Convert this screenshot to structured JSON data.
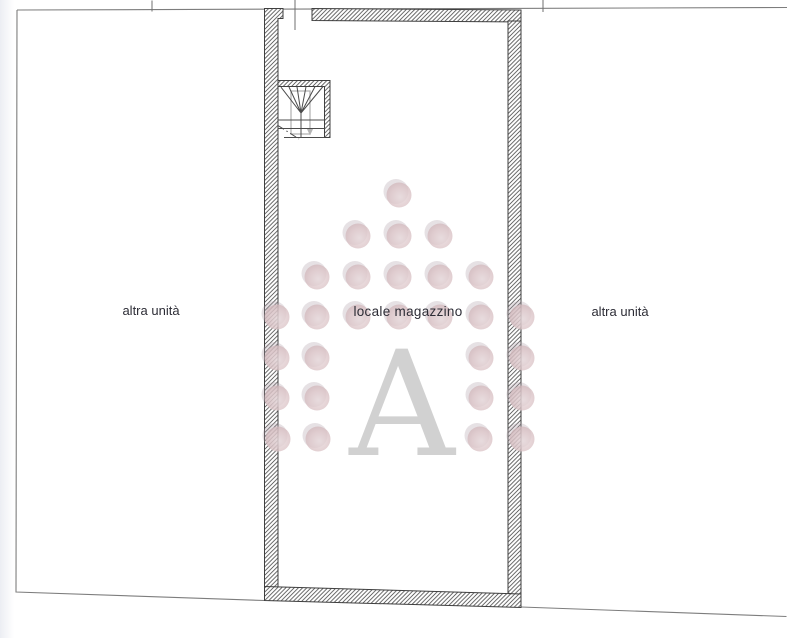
{
  "labels": {
    "left_unit": "altra unità",
    "storage_room": "locale magazzino",
    "right_unit": "altra unità"
  },
  "watermark": {
    "letter": "A",
    "letter_color": "#c8c8c8",
    "circle_color": "#ddc6c9",
    "circle_radius": 12.5,
    "rows": [
      {
        "y": 195,
        "xs": [
          399
        ]
      },
      {
        "y": 236,
        "xs": [
          358,
          399,
          440
        ]
      },
      {
        "y": 277,
        "xs": [
          317,
          358,
          399,
          440,
          481
        ]
      },
      {
        "y": 317,
        "xs": [
          277,
          317,
          358,
          399,
          440,
          481,
          522
        ]
      },
      {
        "y": 358,
        "xs": [
          277,
          317,
          481,
          522
        ]
      },
      {
        "y": 398,
        "xs": [
          277,
          317,
          481,
          522
        ]
      },
      {
        "y": 439,
        "xs": [
          278,
          318,
          480,
          522
        ]
      }
    ]
  },
  "colors": {
    "boundary_line": "#7d7d7d",
    "wall_outline": "#3f3f3f",
    "hatch_line": "#4a4a4a",
    "label_text": "#2d2d36"
  }
}
